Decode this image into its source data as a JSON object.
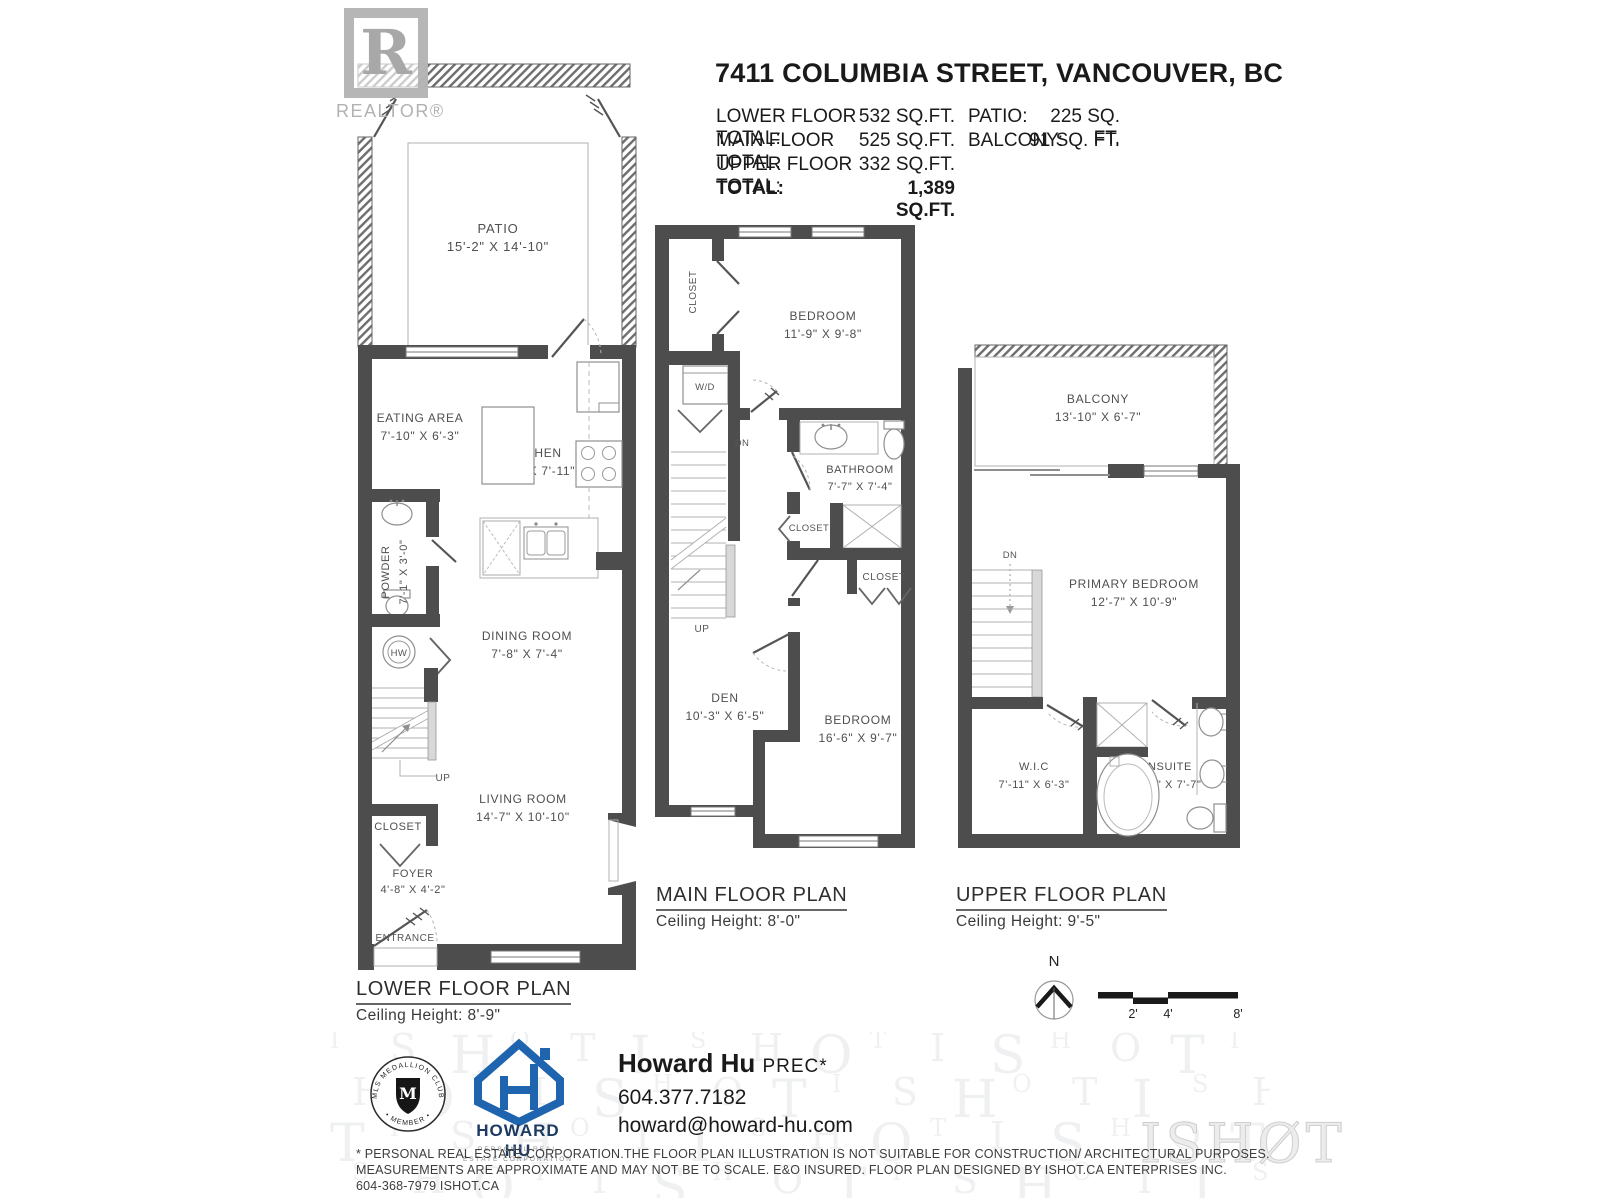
{
  "header": {
    "title": "7411 COLUMBIA STREET, VANCOUVER, BC",
    "rows": [
      {
        "label": "LOWER FLOOR TOTAL:",
        "value": "532 SQ.FT."
      },
      {
        "label": "MAIN FLOOR TOTAL:",
        "value": "525 SQ.FT."
      },
      {
        "label": "UPPER FLOOR TOTAL:",
        "value": "332 SQ.FT."
      },
      {
        "label": "TOTAL:",
        "value": "1,389 SQ.FT."
      }
    ],
    "side_rows": [
      {
        "label": "PATIO:",
        "value": "225 SQ. FT."
      },
      {
        "label": "BALCONY:",
        "value": "91 SQ. FT."
      }
    ]
  },
  "realtor": {
    "letter": "R",
    "wordmark": "REALTOR®"
  },
  "lower": {
    "plan_label": "LOWER FLOOR PLAN",
    "ceiling": "Ceiling Height: 8'-9\"",
    "rooms": {
      "patio": {
        "name": "PATIO",
        "dims": "15'-2\" X 14'-10\""
      },
      "eating": {
        "name": "EATING AREA",
        "dims": "7'-10\" X 6'-3\""
      },
      "kitchen": {
        "name": "KITCHEN",
        "dims": "11'-9\" X 7'-11\""
      },
      "powder": {
        "name": "POWDER",
        "dims": "7'-1\" X 3'-0\""
      },
      "dining": {
        "name": "DINING ROOM",
        "dims": "7'-8\" X 7'-4\""
      },
      "living": {
        "name": "LIVING ROOM",
        "dims": "14'-7\" X 10'-10\""
      },
      "closet": {
        "name": "CLOSET"
      },
      "foyer": {
        "name": "FOYER",
        "dims": "4'-8\" X 4'-2\""
      }
    },
    "labels": {
      "hw": "HW",
      "up": "UP",
      "entrance": "ENTRANCE"
    }
  },
  "main": {
    "plan_label": "MAIN FLOOR PLAN",
    "ceiling": "Ceiling Height: 8'-0\"",
    "rooms": {
      "closet_top": {
        "name": "CLOSET"
      },
      "bedroom1": {
        "name": "BEDROOM",
        "dims": "11'-9\" X 9'-8\""
      },
      "bathroom": {
        "name": "BATHROOM",
        "dims": "7'-7\" X 7'-4\""
      },
      "closet_mid": {
        "name": "CLOSET"
      },
      "closet_right": {
        "name": "CLOSET"
      },
      "den": {
        "name": "DEN",
        "dims": "10'-3\" X 6'-5\""
      },
      "bedroom2": {
        "name": "BEDROOM",
        "dims": "16'-6\" X 9'-7\""
      }
    },
    "labels": {
      "wd": "W/D",
      "dn": "DN",
      "up": "UP"
    }
  },
  "upper": {
    "plan_label": "UPPER FLOOR PLAN",
    "ceiling": "Ceiling Height: 9'-5\"",
    "rooms": {
      "balcony": {
        "name": "BALCONY",
        "dims": "13'-10\" X 6'-7\""
      },
      "primary": {
        "name": "PRIMARY BEDROOM",
        "dims": "12'-7\" X 10'-9\""
      },
      "wic": {
        "name": "W.I.C",
        "dims": "7'-11\" X 6'-3\""
      },
      "ensuite": {
        "name": "ENSUITE",
        "dims": "7'-11\" X 7'-7\""
      }
    },
    "labels": {
      "dn": "DN"
    }
  },
  "compass": {
    "north": "N"
  },
  "scalebar": {
    "labels": [
      "2'",
      "4'",
      "8'"
    ]
  },
  "footer": {
    "medallion": {
      "top": "MLS MEDALLION CLUB",
      "bottom": "• MEMBER •",
      "center": "M"
    },
    "brand": {
      "name": "HOWARD HU",
      "sub1": "PERSONAL REAL",
      "sub2": "ESTATE CORPORATION"
    },
    "agent": {
      "name": "Howard Hu",
      "designation": "PREC*",
      "phone": "604.377.7182",
      "email": "howard@howard-hu.com"
    },
    "disclaimer": [
      "* PERSONAL REAL ESTATE CORPORATION.THE FLOOR PLAN ILLUSTRATION IS NOT SUITABLE FOR CONSTRUCTION/ ARCHITECTURAL PURPOSES.",
      "MEASUREMENTS ARE APPROXIMATE AND MAY NOT BE TO SCALE. E&O INSURED. FLOOR PLAN DESIGNED BY ISHOT.CA ENTERPRISES INC.",
      "604-368-7979  ISHOT.CA"
    ],
    "watermark": "ISHOT",
    "watermark_logo": "ISHØT"
  }
}
